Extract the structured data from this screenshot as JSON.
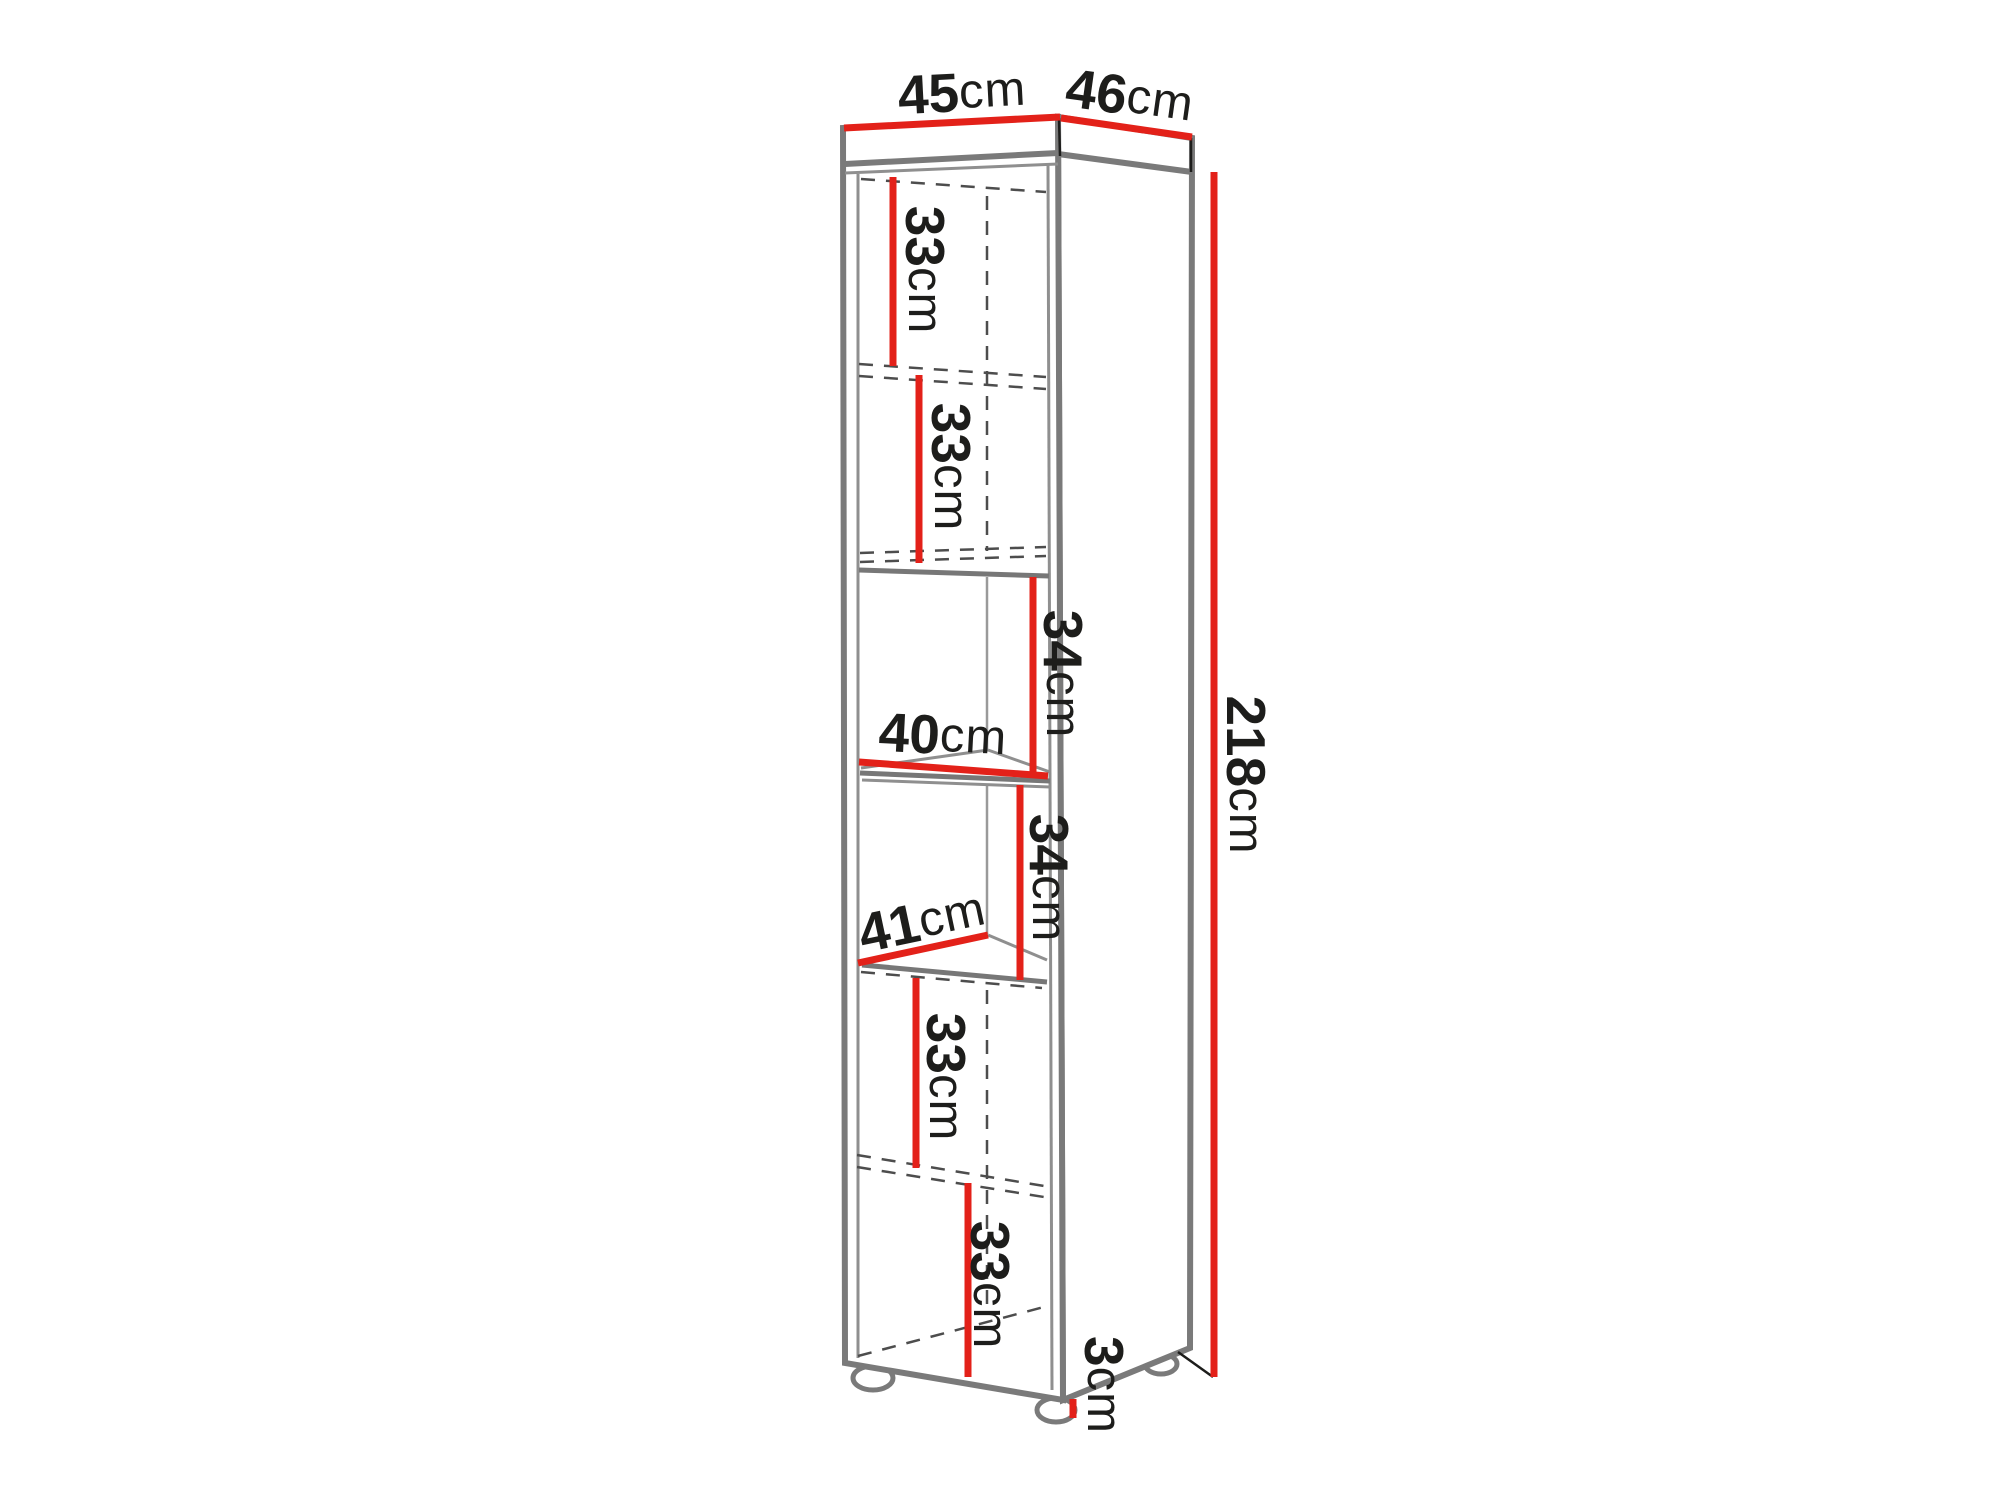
{
  "diagram": {
    "name": "tall-cabinet-dimension-diagram",
    "unit": "cm",
    "colors": {
      "dimension_line": "#e32119",
      "structure_line": "#7a7a7a",
      "hidden_line": "#4d4d4d",
      "text": "#1d1d1b",
      "background": "#ffffff"
    },
    "labels": {
      "width": {
        "value": "45",
        "unit": "cm"
      },
      "depth": {
        "value": "46",
        "unit": "cm"
      },
      "height": {
        "value": "218",
        "unit": "cm"
      },
      "section1": {
        "value": "33",
        "unit": "cm"
      },
      "section2": {
        "value": "33",
        "unit": "cm"
      },
      "section3": {
        "value": "34",
        "unit": "cm"
      },
      "shelf_width": {
        "value": "40",
        "unit": "cm"
      },
      "section4": {
        "value": "34",
        "unit": "cm"
      },
      "shelf_depth": {
        "value": "41",
        "unit": "cm"
      },
      "section5": {
        "value": "33",
        "unit": "cm"
      },
      "section6": {
        "value": "33",
        "unit": "cm"
      },
      "feet_height": {
        "value": "3",
        "unit": "cm"
      }
    }
  }
}
